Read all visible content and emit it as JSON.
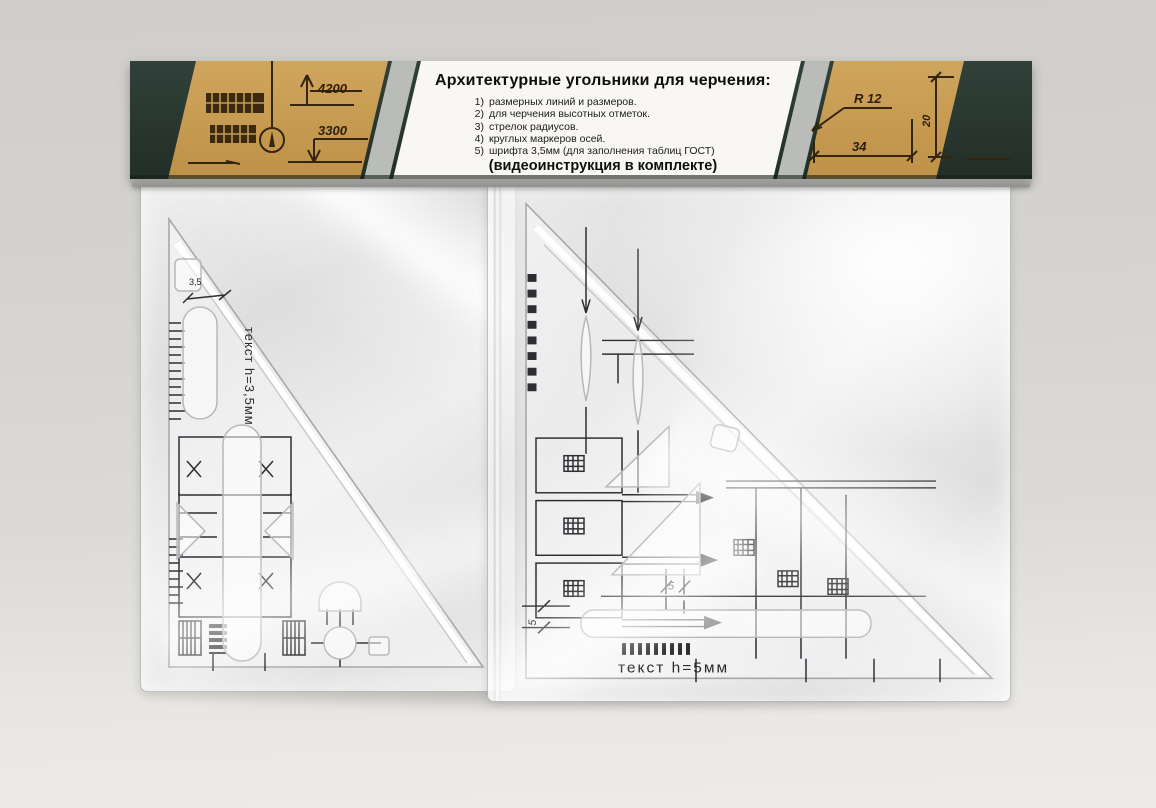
{
  "header": {
    "title": "Архитектурные угольники для черчения:",
    "features": [
      {
        "num": "1)",
        "text": "размерных линий и размеров."
      },
      {
        "num": "2)",
        "text": "для черчения высотных отметок."
      },
      {
        "num": "3)",
        "text": "стрелок радиусов."
      },
      {
        "num": "4)",
        "text": "круглых маркеров осей."
      },
      {
        "num": "5)",
        "text": "шрифта 3,5мм (для заполнения таблиц ГОСТ)"
      }
    ],
    "note": "(видеоинструкция в комплекте)",
    "left_drawing": {
      "dim_top": "4200",
      "dim_bottom": "3300"
    },
    "right_drawing": {
      "radius_label": "R 12",
      "width_label": "34",
      "height_label": "20"
    }
  },
  "left_triangle": {
    "label": "текст h=3,5мм",
    "dim": "3,5"
  },
  "right_triangle": {
    "label": "текст h=5мм",
    "dim_center": "5",
    "dim_left": "5"
  },
  "colors": {
    "board_green": "#2a372e",
    "kraft": "#c79b50",
    "stripe": "#b9bcb8",
    "panel_white": "#f8f7f3",
    "wall": "#d6d4d1",
    "print_ink": "#2e2e32"
  }
}
